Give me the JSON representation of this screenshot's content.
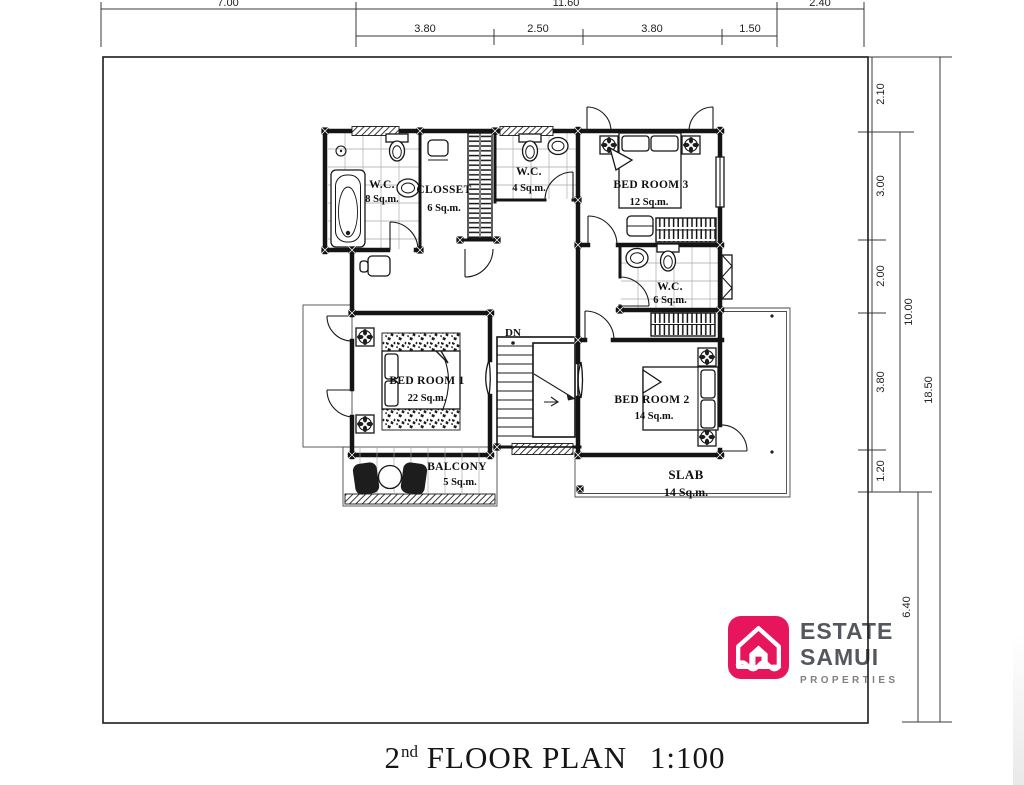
{
  "title": {
    "number": "2",
    "suffix": "nd",
    "name": "FLOOR PLAN",
    "scale": "1:100"
  },
  "logo": {
    "line1": "ESTATE",
    "line2": "SAMUI",
    "line3": "PROPERTIES",
    "accent_color": "#e7155c",
    "text_color": "#54575b",
    "sub_text_color": "#7d8184"
  },
  "rooms": [
    {
      "id": "wc8",
      "name": "W.C.",
      "area": "8 Sq.m."
    },
    {
      "id": "closset",
      "name": "CLOSSET",
      "area": "6 Sq.m."
    },
    {
      "id": "wc4",
      "name": "W.C.",
      "area": "4 Sq.m."
    },
    {
      "id": "bedroom3",
      "name": "BED ROOM 3",
      "area": "12 Sq.m."
    },
    {
      "id": "wc6",
      "name": "W.C.",
      "area": "6 Sq.m."
    },
    {
      "id": "bedroom1",
      "name": "BED ROOM 1",
      "area": "22 Sq.m."
    },
    {
      "id": "bedroom2",
      "name": "BED ROOM 2",
      "area": "14 Sq.m."
    },
    {
      "id": "balcony",
      "name": "BALCONY",
      "area": "5 Sq.m."
    },
    {
      "id": "slab",
      "name": "SLAB",
      "area": "14 Sq.m."
    }
  ],
  "stairs": {
    "direction_label": "DN"
  },
  "dims": {
    "top_primary": [
      "7.00",
      "11.60",
      "2.40"
    ],
    "top_secondary": [
      "3.80",
      "2.50",
      "3.80",
      "1.50"
    ],
    "right_segments": [
      "2.10",
      "3.00",
      "2.00",
      "3.80",
      "1.20"
    ],
    "right_subtotal": "10.00",
    "right_lower": "6.40",
    "right_total": "18.50"
  },
  "icons": {
    "bathtub": "rounded-rect-with-oval",
    "toilet": "tank-and-bowl",
    "wash-basin": "oval",
    "ceiling-fan": "four-petal-square",
    "staircase": "treads-with-break-line",
    "armchair": "dark-rounded-seat",
    "round-table": "circle",
    "wardrobe": "striped-rect",
    "logo-house": "house-outline-over-waves"
  },
  "line_color": "#141414"
}
